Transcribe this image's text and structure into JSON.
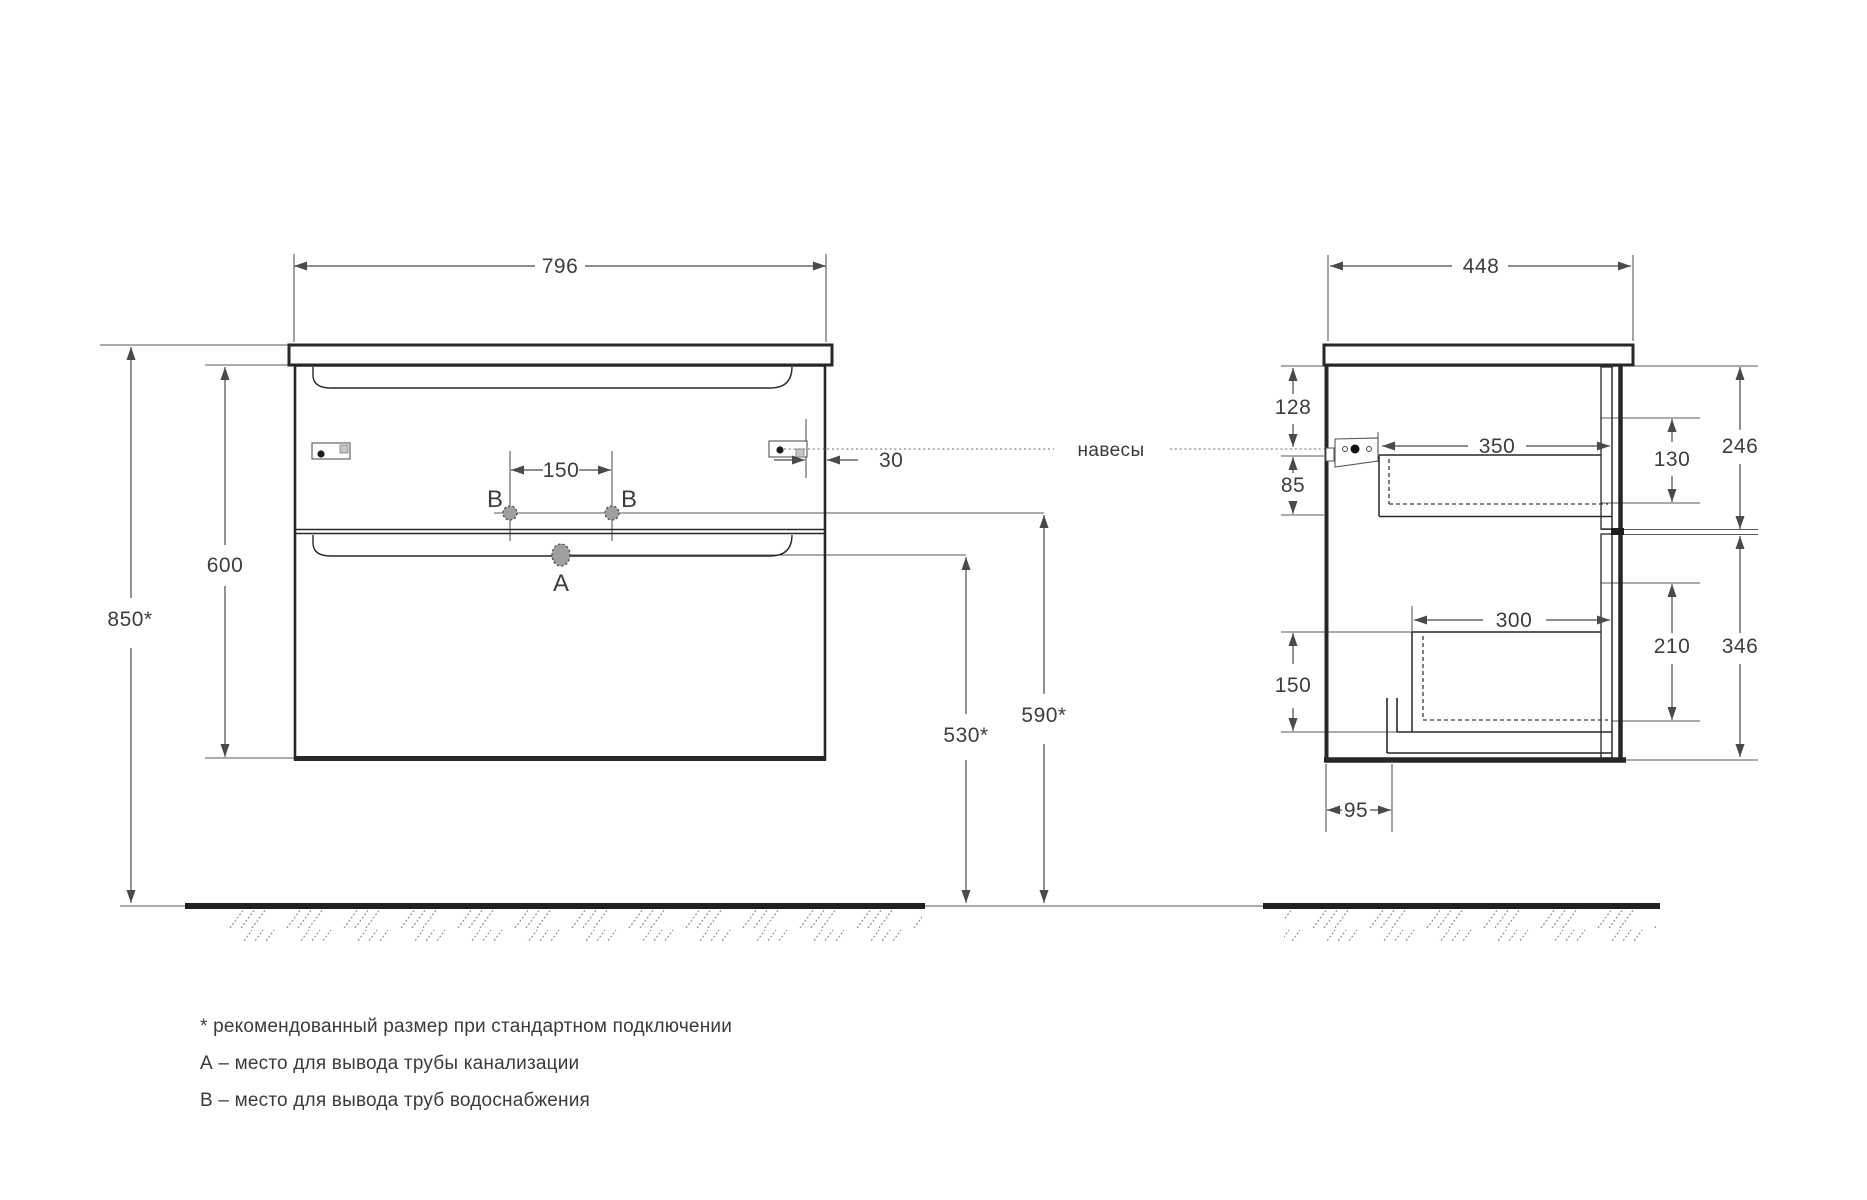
{
  "front_view": {
    "width": "796",
    "cabinet_height": "600",
    "mounting_height": "850*",
    "supply_spacing": "150",
    "bracket_offset": "30",
    "supply_height": "590*",
    "drain_height": "530*",
    "point_a": "A",
    "point_b": "B"
  },
  "side_view": {
    "depth": "448",
    "bracket_top_offset": "128",
    "bracket_bottom_gap": "85",
    "upper_drawer_depth": "350",
    "upper_drawer_front_height": "246",
    "upper_drawer_side_height": "130",
    "lower_drawer_depth": "300",
    "lower_drawer_side_height": "210",
    "lower_drawer_front_height": "346",
    "bottom_drawer_offset": "150",
    "pipe_offset": "95"
  },
  "annotations": {
    "hangers": "навесы"
  },
  "legend": {
    "asterisk_note": "* рекомендованный размер при стандартном подключении",
    "a_note": "А – место для вывода трубы канализации",
    "b_note": "В – место для вывода труб водоснабжения"
  },
  "colors": {
    "outline": "#29262a",
    "dimension": "#4a4a4a",
    "hole_fill": "#9f9f9f"
  }
}
